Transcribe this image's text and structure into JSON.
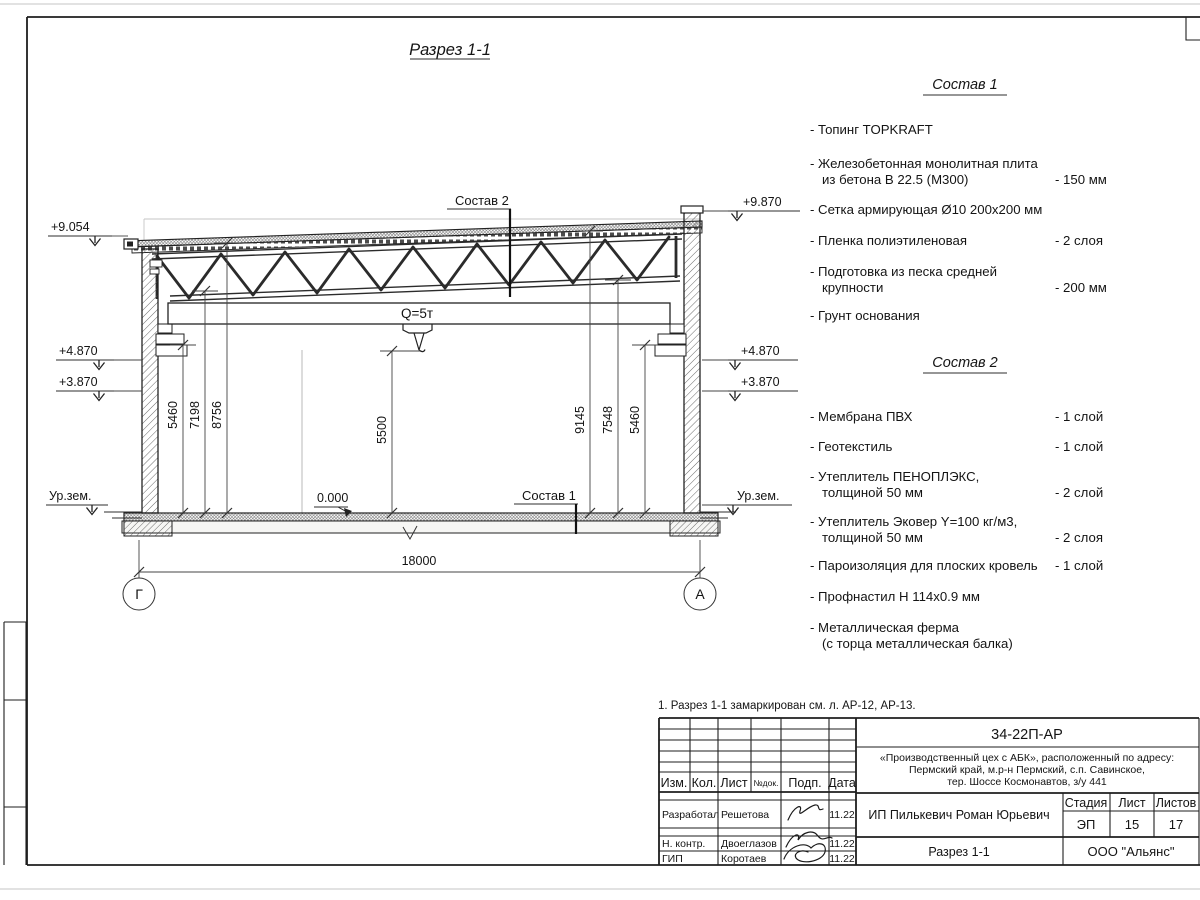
{
  "sheet": {
    "title": "Разрез 1-1",
    "note": "1. Разрез 1-1 замаркирован см. л. АР-12, АР-13."
  },
  "section": {
    "ref_top": "Состав 2",
    "ref_floor": "Состав 1",
    "crane_label": "Q=5т",
    "zero_mark": "0.000",
    "elev": {
      "l1": "+9.054",
      "l2": "+4.870",
      "l3": "+3.870",
      "l4": "Ур.зем.",
      "r1": "+9.870",
      "r2": "+4.870",
      "r3": "+3.870",
      "r4": "Ур.зем."
    },
    "dims": {
      "left": [
        "5460",
        "7198",
        "8756"
      ],
      "center": "5500",
      "right": [
        "9145",
        "7548",
        "5460"
      ],
      "span": "18000"
    },
    "axes": {
      "left": "Г",
      "right": "А"
    }
  },
  "sostav1": {
    "title": "Состав 1",
    "items": [
      {
        "t1": "- Топинг TOPKRAFT",
        "t2": "",
        "v": ""
      },
      {
        "t1": "- Железобетонная  монолитная плита",
        "t2": "из бетона В 22.5 (М300)",
        "v": "- 150 мм"
      },
      {
        "t1": "- Сетка армирующая Ø10 200х200 мм",
        "t2": "",
        "v": ""
      },
      {
        "t1": "- Пленка полиэтиленовая",
        "t2": "",
        "v": "-  2 слоя"
      },
      {
        "t1": "- Подготовка из песка средней",
        "t2": "крупности",
        "v": "- 200 мм"
      },
      {
        "t1": "- Грунт основания",
        "t2": "",
        "v": ""
      }
    ]
  },
  "sostav2": {
    "title": "Состав 2",
    "items": [
      {
        "t1": "- Мембрана ПВХ",
        "t2": "",
        "v": "- 1 слой"
      },
      {
        "t1": "- Геотекстиль",
        "t2": "",
        "v": "- 1 слой"
      },
      {
        "t1": "- Утеплитель ПЕНОПЛЭКС,",
        "t2": "толщиной 50 мм",
        "v": "- 2 слой"
      },
      {
        "t1": "- Утеплитель Эковер Y=100 кг/м3,",
        "t2": "толщиной 50 мм",
        "v": "- 2 слоя"
      },
      {
        "t1": "- Пароизоляция для плоских кровель",
        "t2": "",
        "v": "- 1 слой"
      },
      {
        "t1": "- Профнастил Н 114х0.9 мм",
        "t2": "",
        "v": ""
      },
      {
        "t1": "- Металлическая ферма",
        "t2": "(с торца металлическая балка)",
        "v": ""
      }
    ]
  },
  "stamp": {
    "doc": "34-22П-АР",
    "project": [
      "«Производственный цех с АБК», расположенный по адресу:",
      "Пермский край, м.р-н Пермский, с.п. Савинское,",
      "тер. Шоссе Космонавтов, з/у 441"
    ],
    "cols": [
      "Изм.",
      "Кол.",
      "Лист",
      "№док.",
      "Подп.",
      "Дата"
    ],
    "rows": [
      {
        "role": "Разработал",
        "name": "Решетова",
        "date": "11.22"
      },
      {
        "role": "Н. контр.",
        "name": "Двоеглазов",
        "date": "11.22"
      },
      {
        "role": "ГИП",
        "name": "Коротаев",
        "date": "11.22"
      }
    ],
    "client": "ИП Пилькевич Роман Юрьевич",
    "stage_label": "Стадия",
    "sheet_label": "Лист",
    "sheets_label": "Листов",
    "stage": "ЭП",
    "sheet_num": "15",
    "sheets_total": "17",
    "bottom_title": "Разрез 1-1",
    "company": "ООО \"Альянс\""
  }
}
